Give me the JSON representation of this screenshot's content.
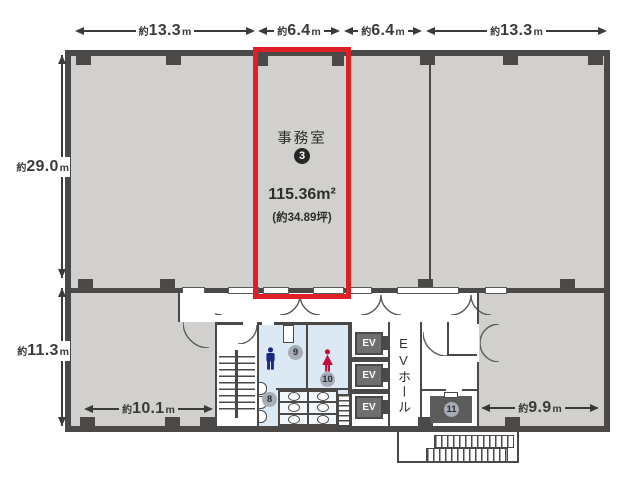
{
  "colors": {
    "wall": "#4a4947",
    "fill": "#d1d0ce",
    "wet": "#dbe9f4",
    "red": "#dd2026",
    "ink": "#3b3b39",
    "evbox": "#6f6f6d",
    "circle": "#a6adb8",
    "circledark": "#262624",
    "man": "#1b2a80",
    "woman": "#c50a3c"
  },
  "dims": {
    "top": [
      {
        "prefix": "約",
        "value": "13.3",
        "unit": "m"
      },
      {
        "prefix": "約",
        "value": "6.4",
        "unit": "m"
      },
      {
        "prefix": "約",
        "value": "6.4",
        "unit": "m"
      },
      {
        "prefix": "約",
        "value": "13.3",
        "unit": "m"
      }
    ],
    "left": [
      {
        "prefix": "約",
        "value": "29.0",
        "unit": "m"
      },
      {
        "prefix": "約",
        "value": "11.3",
        "unit": "m"
      }
    ],
    "bottom": [
      {
        "prefix": "約",
        "value": "10.1",
        "unit": "m"
      },
      {
        "prefix": "約",
        "value": "9.9",
        "unit": "m"
      }
    ]
  },
  "room": {
    "name": "事務室",
    "number": "3",
    "area": "115.36m²",
    "area_tsubo": "(約34.89坪)"
  },
  "elevator": {
    "box_label": "EV",
    "hall_label": "EVホール"
  },
  "fixtures": {
    "urinal_area": "8",
    "mens_room": "9",
    "womens_room": "10",
    "utility_room": "11"
  }
}
